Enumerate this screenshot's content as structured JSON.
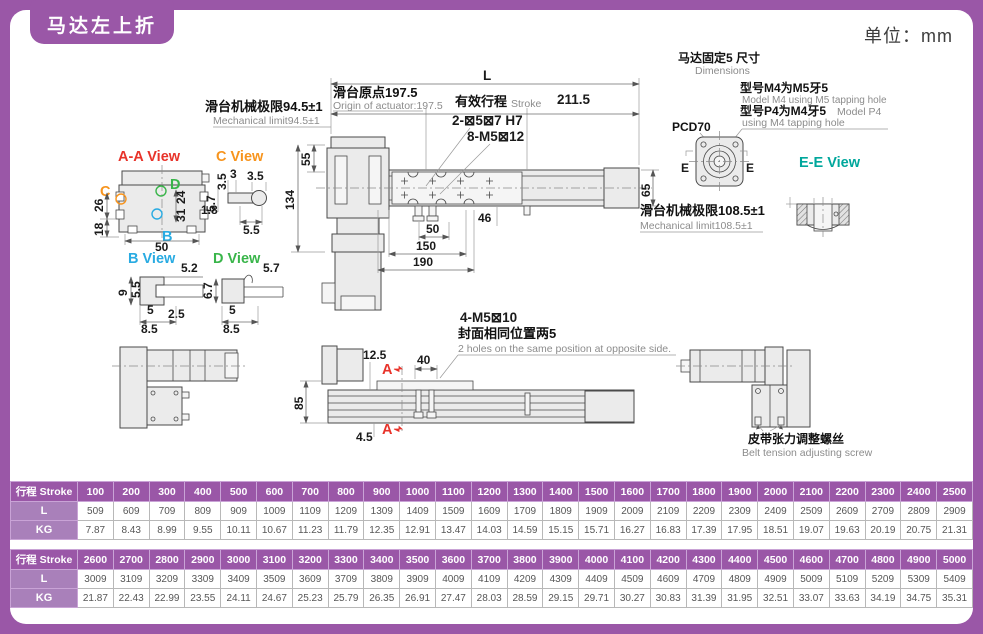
{
  "page": {
    "title": "马达左上折",
    "unit": "单位：mm"
  },
  "colors": {
    "purple": "#9a57a7",
    "purple_light": "#a980ba",
    "red": "#e8332a",
    "orange": "#f7941d",
    "blue": "#29abe2",
    "green": "#39b54a",
    "teal": "#00a79c"
  },
  "top_view": {
    "dim_l": "L",
    "origin_cn": "滑台原点197.5",
    "origin_en": "Origin of actuator:197.5",
    "stroke_cn": "有效行程",
    "stroke_en": "Stroke",
    "d2115": "211.5",
    "mech_left_cn": "滑台机械极限94.5±1",
    "mech_left_en": "Mechanical limit94.5±1",
    "mech_right_cn": "滑台机械极限108.5±1",
    "mech_right_en": "Mechanical limit108.5±1",
    "holes1": "2-⊠5⊠7 H7",
    "holes2": "8-M5⊠12",
    "d55": "55",
    "d134": "134",
    "d65": "65",
    "d46": "46",
    "d50": "50",
    "d150": "150",
    "d190": "190"
  },
  "motor_info": {
    "title_cn": "马达固定5 尺寸",
    "title_en": "Dimensions",
    "m4_cn": "型号M4为M5牙5",
    "m4_en": "Model M4 using M5 tapping hole",
    "p4_cn": "型号P4为M4牙5",
    "p4_mid": "Model P4",
    "p4_en": "using M4 tapping hole",
    "pcd": "PCD70",
    "e_left": "E",
    "e_right": "E"
  },
  "views": {
    "aa": {
      "label": "A-A View",
      "letters": {
        "c": "C",
        "d": "D",
        "b": "B"
      },
      "dims": {
        "d26": "26",
        "d18": "18",
        "d50": "50",
        "d24": "24",
        "d31": "31"
      }
    },
    "c": {
      "label": "C View",
      "dims": {
        "d35a": "3.5",
        "d3": "3",
        "d35b": "3.5",
        "d57": "5.7",
        "d18": "1.8",
        "d55": "5.5"
      }
    },
    "b": {
      "label": "B View",
      "dims": {
        "d52": "5.2",
        "d9": "9",
        "d55": "5.5",
        "d5": "5",
        "d25": "2.5",
        "d85": "8.5"
      }
    },
    "d": {
      "label": "D View",
      "dims": {
        "d57": "5.7",
        "d67": "6.7",
        "d5": "5",
        "d85": "8.5"
      }
    },
    "ee": {
      "label": "E-E View",
      "dims": {
        "d50h8": "⊠50 H8",
        "d14": "⊠14",
        "d6": "6"
      }
    }
  },
  "side_view": {
    "d125": "12.5",
    "d40": "40",
    "d85": "85",
    "d45": "4.5",
    "a_top": "A",
    "a_bottom": "A",
    "m5_cn": "4-M5⊠10",
    "pos_cn": "封面相同位置两5",
    "pos_en": "2 holes on the same position at opposite side.",
    "belt_cn": "皮带张力调整螺丝",
    "belt_en": "Belt tension adjusting screw"
  },
  "tables": [
    {
      "header_label": "行程 Stroke",
      "strokes": [
        "100",
        "200",
        "300",
        "400",
        "500",
        "600",
        "700",
        "800",
        "900",
        "1000",
        "1100",
        "1200",
        "1300",
        "1400",
        "1500",
        "1600",
        "1700",
        "1800",
        "1900",
        "2000",
        "2100",
        "2200",
        "2300",
        "2400",
        "2500"
      ],
      "rows": [
        {
          "label": "L",
          "values": [
            "509",
            "609",
            "709",
            "809",
            "909",
            "1009",
            "1109",
            "1209",
            "1309",
            "1409",
            "1509",
            "1609",
            "1709",
            "1809",
            "1909",
            "2009",
            "2109",
            "2209",
            "2309",
            "2409",
            "2509",
            "2609",
            "2709",
            "2809",
            "2909"
          ]
        },
        {
          "label": "KG",
          "values": [
            "7.87",
            "8.43",
            "8.99",
            "9.55",
            "10.11",
            "10.67",
            "11.23",
            "11.79",
            "12.35",
            "12.91",
            "13.47",
            "14.03",
            "14.59",
            "15.15",
            "15.71",
            "16.27",
            "16.83",
            "17.39",
            "17.95",
            "18.51",
            "19.07",
            "19.63",
            "20.19",
            "20.75",
            "21.31"
          ]
        }
      ]
    },
    {
      "header_label": "行程 Stroke",
      "strokes": [
        "2600",
        "2700",
        "2800",
        "2900",
        "3000",
        "3100",
        "3200",
        "3300",
        "3400",
        "3500",
        "3600",
        "3700",
        "3800",
        "3900",
        "4000",
        "4100",
        "4200",
        "4300",
        "4400",
        "4500",
        "4600",
        "4700",
        "4800",
        "4900",
        "5000"
      ],
      "rows": [
        {
          "label": "L",
          "values": [
            "3009",
            "3109",
            "3209",
            "3309",
            "3409",
            "3509",
            "3609",
            "3709",
            "3809",
            "3909",
            "4009",
            "4109",
            "4209",
            "4309",
            "4409",
            "4509",
            "4609",
            "4709",
            "4809",
            "4909",
            "5009",
            "5109",
            "5209",
            "5309",
            "5409"
          ]
        },
        {
          "label": "KG",
          "values": [
            "21.87",
            "22.43",
            "22.99",
            "23.55",
            "24.11",
            "24.67",
            "25.23",
            "25.79",
            "26.35",
            "26.91",
            "27.47",
            "28.03",
            "28.59",
            "29.15",
            "29.71",
            "30.27",
            "30.83",
            "31.39",
            "31.95",
            "32.51",
            "33.07",
            "33.63",
            "34.19",
            "34.75",
            "35.31"
          ]
        }
      ]
    }
  ]
}
